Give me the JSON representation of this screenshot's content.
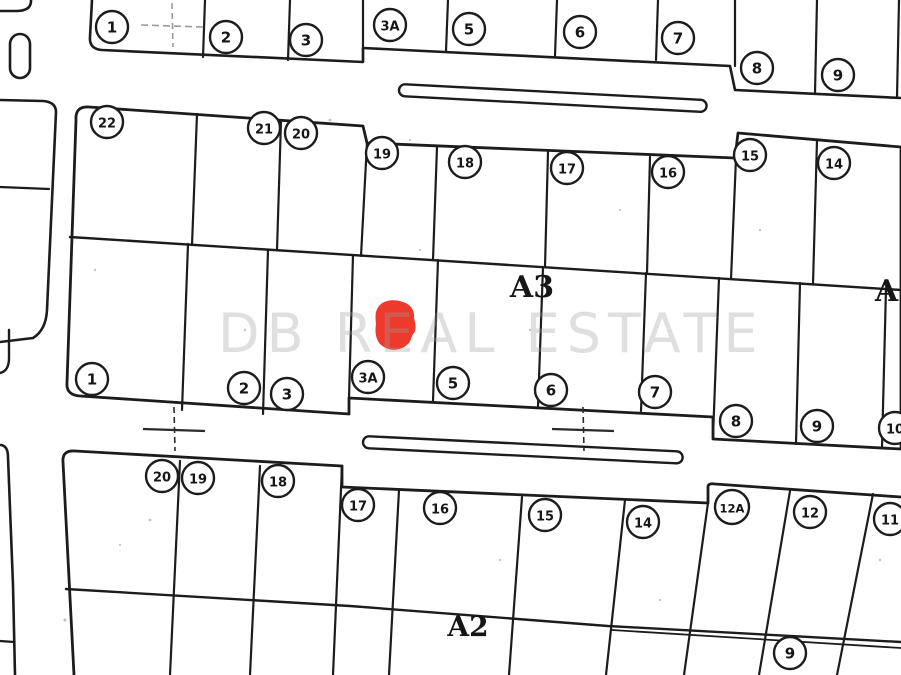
{
  "page": {
    "background": "#ffffff",
    "ink_color": "#1c1c1c"
  },
  "watermark": {
    "text": "DB REAL ESTATE"
  },
  "marker": {
    "name": "red-location-marker",
    "color": "#ee3a2b",
    "x": 395,
    "y": 326
  },
  "block_labels": [
    {
      "text": "A3",
      "x": 532,
      "y": 297,
      "size": 30
    },
    {
      "text": "A3",
      "x": 897,
      "y": 301,
      "size": 30
    },
    {
      "text": "A2",
      "x": 468,
      "y": 636,
      "size": 28
    }
  ],
  "survey_crosses": [
    {
      "x": 172,
      "y": 25
    },
    {
      "x": 174,
      "y": 429
    },
    {
      "x": 583,
      "y": 429
    }
  ],
  "lot_badges": {
    "top_row": [
      {
        "label": "1",
        "x": 112,
        "y": 27
      },
      {
        "label": "2",
        "x": 226,
        "y": 37
      },
      {
        "label": "3",
        "x": 306,
        "y": 40
      },
      {
        "label": "3A",
        "x": 390,
        "y": 25
      },
      {
        "label": "5",
        "x": 469,
        "y": 29
      },
      {
        "label": "6",
        "x": 580,
        "y": 32
      },
      {
        "label": "7",
        "x": 678,
        "y": 38
      },
      {
        "label": "8",
        "x": 757,
        "y": 68
      },
      {
        "label": "9",
        "x": 838,
        "y": 75
      }
    ],
    "a3_upper": [
      {
        "label": "22",
        "x": 107,
        "y": 122
      },
      {
        "label": "21",
        "x": 264,
        "y": 128
      },
      {
        "label": "20",
        "x": 301,
        "y": 133
      },
      {
        "label": "19",
        "x": 382,
        "y": 153
      },
      {
        "label": "18",
        "x": 465,
        "y": 162
      },
      {
        "label": "17",
        "x": 567,
        "y": 168
      },
      {
        "label": "16",
        "x": 668,
        "y": 172
      },
      {
        "label": "15",
        "x": 750,
        "y": 155
      },
      {
        "label": "14",
        "x": 834,
        "y": 163
      }
    ],
    "a3_lower": [
      {
        "label": "1",
        "x": 92,
        "y": 379
      },
      {
        "label": "2",
        "x": 244,
        "y": 388
      },
      {
        "label": "3",
        "x": 287,
        "y": 394
      },
      {
        "label": "3A",
        "x": 368,
        "y": 377
      },
      {
        "label": "5",
        "x": 453,
        "y": 383
      },
      {
        "label": "6",
        "x": 551,
        "y": 390
      },
      {
        "label": "7",
        "x": 655,
        "y": 392
      },
      {
        "label": "8",
        "x": 736,
        "y": 421
      },
      {
        "label": "9",
        "x": 817,
        "y": 426
      },
      {
        "label": "10",
        "x": 895,
        "y": 428
      }
    ],
    "a2_row": [
      {
        "label": "20",
        "x": 162,
        "y": 476
      },
      {
        "label": "19",
        "x": 198,
        "y": 478
      },
      {
        "label": "18",
        "x": 278,
        "y": 481
      },
      {
        "label": "17",
        "x": 358,
        "y": 505
      },
      {
        "label": "16",
        "x": 440,
        "y": 508
      },
      {
        "label": "15",
        "x": 545,
        "y": 515
      },
      {
        "label": "14",
        "x": 643,
        "y": 522
      },
      {
        "label": "12A",
        "x": 732,
        "y": 507
      },
      {
        "label": "12",
        "x": 810,
        "y": 512
      },
      {
        "label": "11",
        "x": 890,
        "y": 519
      }
    ],
    "a2_lower": [
      {
        "label": "9",
        "x": 790,
        "y": 653
      }
    ]
  }
}
